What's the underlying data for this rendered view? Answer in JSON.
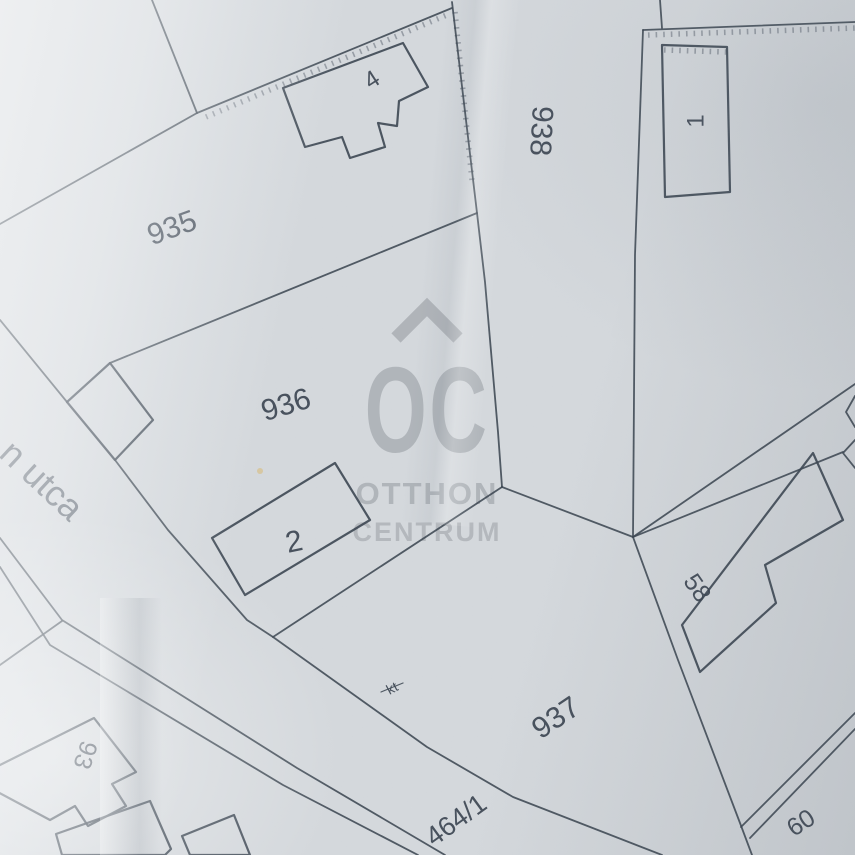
{
  "map": {
    "colors": {
      "paper": "#d5d9dd",
      "ink": "#3a4450",
      "ink_soft": "#49535f",
      "watermark": "#8d9298",
      "speck": "#d9c187"
    },
    "parcel_labels": [
      {
        "name": "parcel-label-935",
        "text": "935",
        "x": 172,
        "y": 228,
        "rotate": -20,
        "size": 30
      },
      {
        "name": "parcel-label-936",
        "text": "936",
        "x": 286,
        "y": 405,
        "rotate": -17,
        "size": 30
      },
      {
        "name": "parcel-label-937",
        "text": "937",
        "x": 556,
        "y": 718,
        "rotate": -34,
        "size": 30
      },
      {
        "name": "parcel-label-938",
        "text": "938",
        "x": 541,
        "y": 131,
        "rotate": 93,
        "size": 30
      },
      {
        "name": "parcel-label-464-1",
        "text": "464/1",
        "x": 456,
        "y": 820,
        "rotate": -36,
        "size": 27
      },
      {
        "name": "parcel-label-93",
        "text": "93",
        "x": 85,
        "y": 755,
        "rotate": 108,
        "size": 25
      },
      {
        "name": "parcel-label-58",
        "text": "58",
        "x": 697,
        "y": 588,
        "rotate": 55,
        "size": 25
      },
      {
        "name": "parcel-label-60",
        "text": "60",
        "x": 801,
        "y": 823,
        "rotate": -33,
        "size": 25
      },
      {
        "name": "annotation-kt",
        "text": "kt",
        "x": 392,
        "y": 688,
        "rotate": -28,
        "size": 14
      }
    ],
    "building_labels": [
      {
        "name": "building-label-4",
        "text": "4",
        "x": 372,
        "y": 80,
        "rotate": -33,
        "size": 24
      },
      {
        "name": "building-label-1",
        "text": "1",
        "x": 696,
        "y": 121,
        "rotate": -90,
        "size": 24
      },
      {
        "name": "building-label-2",
        "text": "2",
        "x": 294,
        "y": 542,
        "rotate": -12,
        "size": 30
      }
    ],
    "street_label": {
      "name": "street-label-utca",
      "text": "n utca",
      "x": 42,
      "y": 480,
      "rotate": 43,
      "size": 36
    },
    "watermark": {
      "logo": "OC",
      "line1": "OTTHON",
      "line2": "CENTRUM"
    },
    "lines": [
      {
        "name": "boundary-topleft-steep",
        "pts": "152,0 197,113"
      },
      {
        "name": "boundary-935-west",
        "pts": "197,113 0,224"
      },
      {
        "name": "boundary-935-north",
        "pts": "197,113 452,8"
      },
      {
        "name": "boundary-938-west",
        "pts": "452,2 477,213 485,282 498,432 502,487"
      },
      {
        "name": "boundary-935-936",
        "pts": "477,213 110,363"
      },
      {
        "name": "street-ne-edge-upper",
        "pts": "0,320 67,402"
      },
      {
        "name": "street-ne-edge-lower",
        "pts": "115,460 168,530 247,620 273,637"
      },
      {
        "name": "boundary-936-937",
        "pts": "273,637 502,487"
      },
      {
        "name": "road-4641-north-edge",
        "pts": "273,637 427,747 513,797 662,855"
      },
      {
        "name": "boundary-937-east",
        "pts": "633,537 678,660 740,823 752,855"
      },
      {
        "name": "boundary-938-east",
        "pts": "643,30 635,255 633,537"
      },
      {
        "name": "boundary-topright-north",
        "pts": "643,30 855,22"
      },
      {
        "name": "boundary-topright-stub",
        "pts": "660,0 662,28"
      },
      {
        "name": "ray-junction-east-1",
        "pts": "633,537 855,384"
      },
      {
        "name": "ray-junction-east-2",
        "pts": "633,537 843,452"
      },
      {
        "name": "link-junctions",
        "pts": "502,487 633,537"
      },
      {
        "name": "street-sw-edge-outer",
        "pts": "0,538 62,620 297,768 445,855"
      },
      {
        "name": "street-sw-edge-inner",
        "pts": "0,567 50,645 283,785 418,855"
      },
      {
        "name": "street-sw-branch",
        "pts": "0,665 62,621"
      },
      {
        "name": "road-60-edge-outer",
        "pts": "855,713 741,827"
      },
      {
        "name": "road-60-edge-inner",
        "pts": "855,729 750,838"
      },
      {
        "name": "corner-notch-right-1",
        "pts": "855,396 846,412 855,427"
      },
      {
        "name": "corner-notch-right-2",
        "pts": "855,440 843,453 855,468"
      },
      {
        "name": "kt-strike",
        "pts": "381,692 403,683"
      }
    ],
    "hatches": [
      {
        "name": "hatch-935-north",
        "pts": "206,117 449,14"
      },
      {
        "name": "hatch-topright-north",
        "pts": "648,35 855,28"
      },
      {
        "name": "hatch-building-1-top",
        "pts": "664,50 726,52"
      },
      {
        "name": "hatch-938-west",
        "pts": "455,12 472,180"
      }
    ],
    "buildings": [
      {
        "name": "building-4-outline",
        "pts": "283,88 403,43 428,87 399,101 397,126 378,123 385,147 350,158 342,137 305,147"
      },
      {
        "name": "building-1-outline",
        "pts": "662,45 727,47 730,192 665,197"
      },
      {
        "name": "building-2-outline",
        "pts": "335,463 370,520 245,595 212,538"
      },
      {
        "name": "building-58-outline",
        "pts": "813,453 843,520 765,565 776,603 712,661 700,672 682,625"
      },
      {
        "name": "building-93-outline",
        "pts": "-6,768 94,718 136,772 112,784 126,806 88,826 75,806 50,820 -6,790"
      },
      {
        "name": "building-bottom-left-a",
        "pts": "56,834 150,801 171,849 165,855 62,855"
      },
      {
        "name": "building-bottom-left-b",
        "pts": "182,836 234,815 250,855 190,855"
      },
      {
        "name": "street-gate-outline",
        "pts": "67,402 110,363 153,420 115,460"
      }
    ],
    "speck": {
      "x": 260,
      "y": 471,
      "r": 3
    }
  }
}
